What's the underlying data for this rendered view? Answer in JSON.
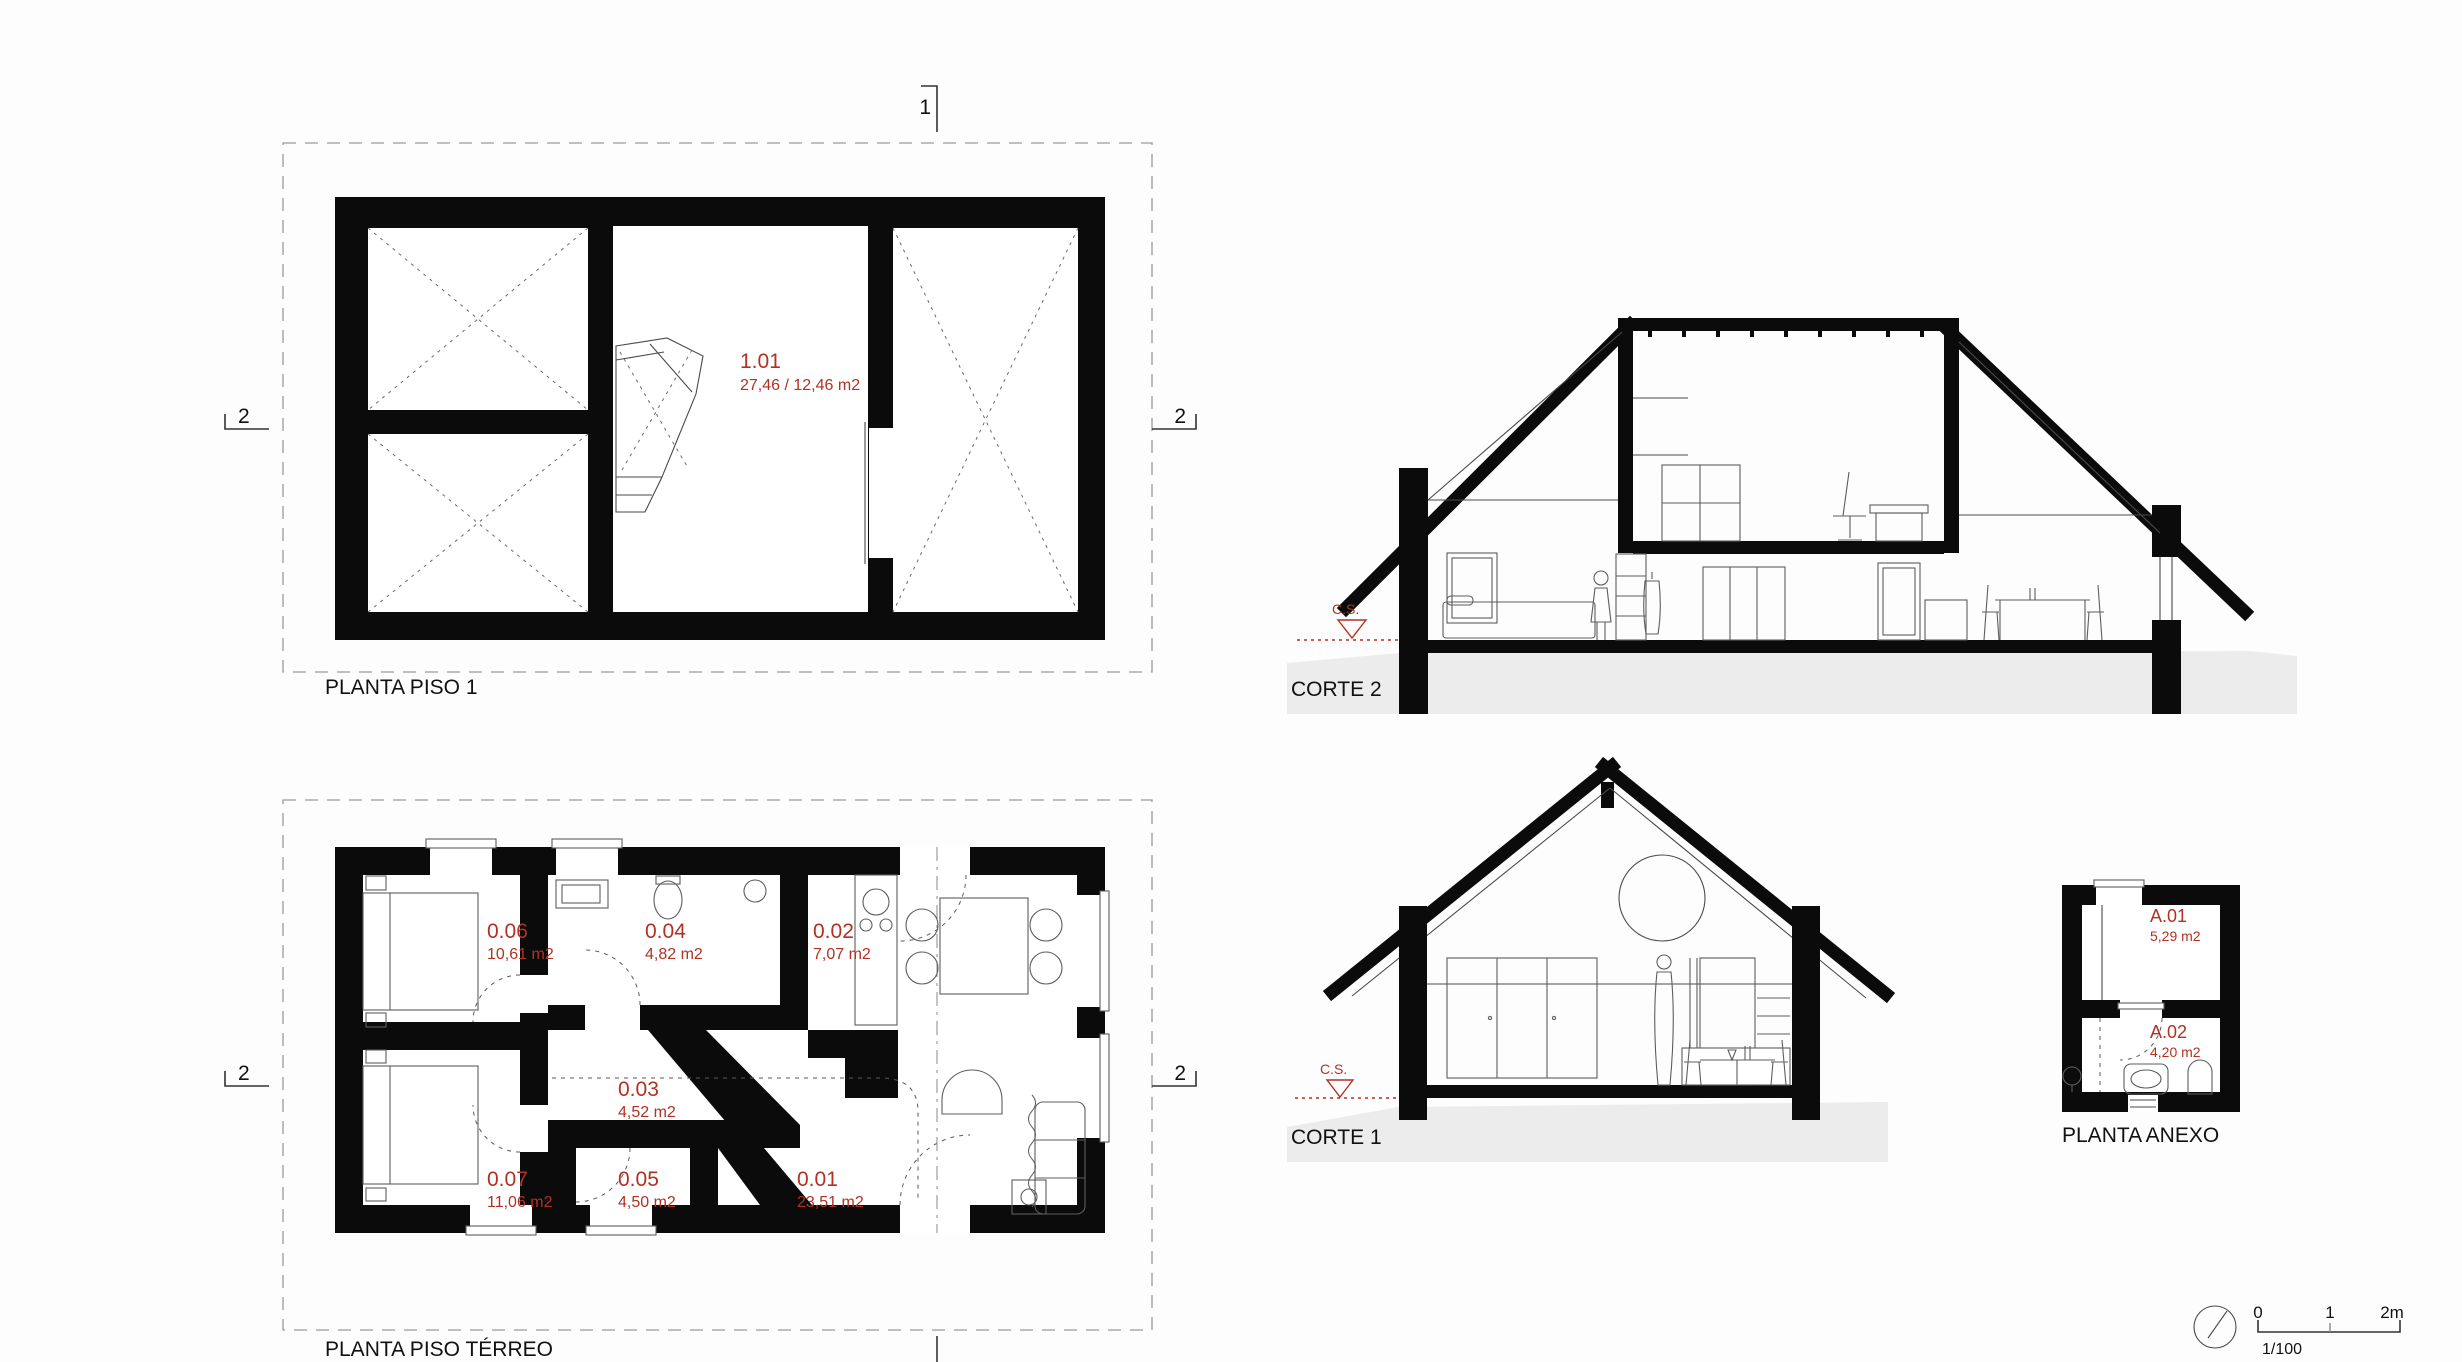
{
  "colors": {
    "accent_red": "#b23122",
    "wall_black": "#0b0b0b",
    "ground_gray": "#ececec"
  },
  "plans": {
    "piso1": {
      "title": "PLANTA PISO 1",
      "rooms": [
        {
          "code": "1.01",
          "area": "27,46 / 12,46 m2"
        }
      ]
    },
    "terreo": {
      "title": "PLANTA PISO TÉRREO",
      "rooms": [
        {
          "code": "0.06",
          "area": "10,61 m2"
        },
        {
          "code": "0.04",
          "area": "4,82 m2"
        },
        {
          "code": "0.02",
          "area": "7,07 m2"
        },
        {
          "code": "0.03",
          "area": "4,52 m2"
        },
        {
          "code": "0.07",
          "area": "11,06 m2"
        },
        {
          "code": "0.05",
          "area": "4,50 m2"
        },
        {
          "code": "0.01",
          "area": "23,51 m2"
        }
      ]
    },
    "anexo": {
      "title": "PLANTA ANEXO",
      "rooms": [
        {
          "code": "A.01",
          "area": "5,29 m2"
        },
        {
          "code": "A.02",
          "area": "4,20 m2"
        }
      ]
    }
  },
  "sections": {
    "corte2": {
      "title": "CORTE 2",
      "datum": "C.S."
    },
    "corte1": {
      "title": "CORTE 1",
      "datum": "C.S."
    }
  },
  "markers": {
    "section1": "1",
    "section2": "2"
  },
  "scalebar": {
    "t0": "0",
    "t1": "1",
    "t2": "2m",
    "ratio": "1/100"
  }
}
